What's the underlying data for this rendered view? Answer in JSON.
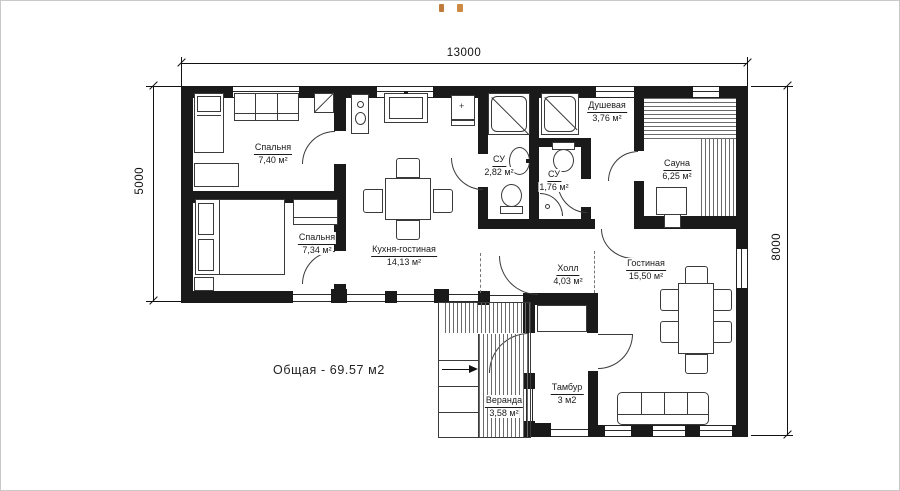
{
  "colors": {
    "wall": "#1a1a1a",
    "line": "#3a3a3a",
    "text": "#1b1b1b",
    "artifact": "#c07b3b"
  },
  "dimensions": {
    "top": "13000",
    "left": "5000",
    "right": "8000"
  },
  "total_area_label": "Общая - 69.57 м2",
  "symbols": {
    "cabinet_plus": "+"
  },
  "rooms": [
    {
      "name": "Спальня",
      "area": "7,40 м²"
    },
    {
      "name": "Спальня",
      "area": "7,34 м²"
    },
    {
      "name": "Кухня-гостиная",
      "area": "14,13 м²"
    },
    {
      "name": "СУ",
      "area": "2,82 м²"
    },
    {
      "name": "СУ",
      "area": "1,76 м²"
    },
    {
      "name": "Душевая",
      "area": "3,76 м²"
    },
    {
      "name": "Сауна",
      "area": "6,25 м²"
    },
    {
      "name": "Гостиная",
      "area": "15,50 м²"
    },
    {
      "name": "Холл",
      "area": "4,03 м²"
    },
    {
      "name": "Тамбур",
      "area": "3 м2"
    },
    {
      "name": "Веранда",
      "area": "3,58 м²"
    }
  ]
}
